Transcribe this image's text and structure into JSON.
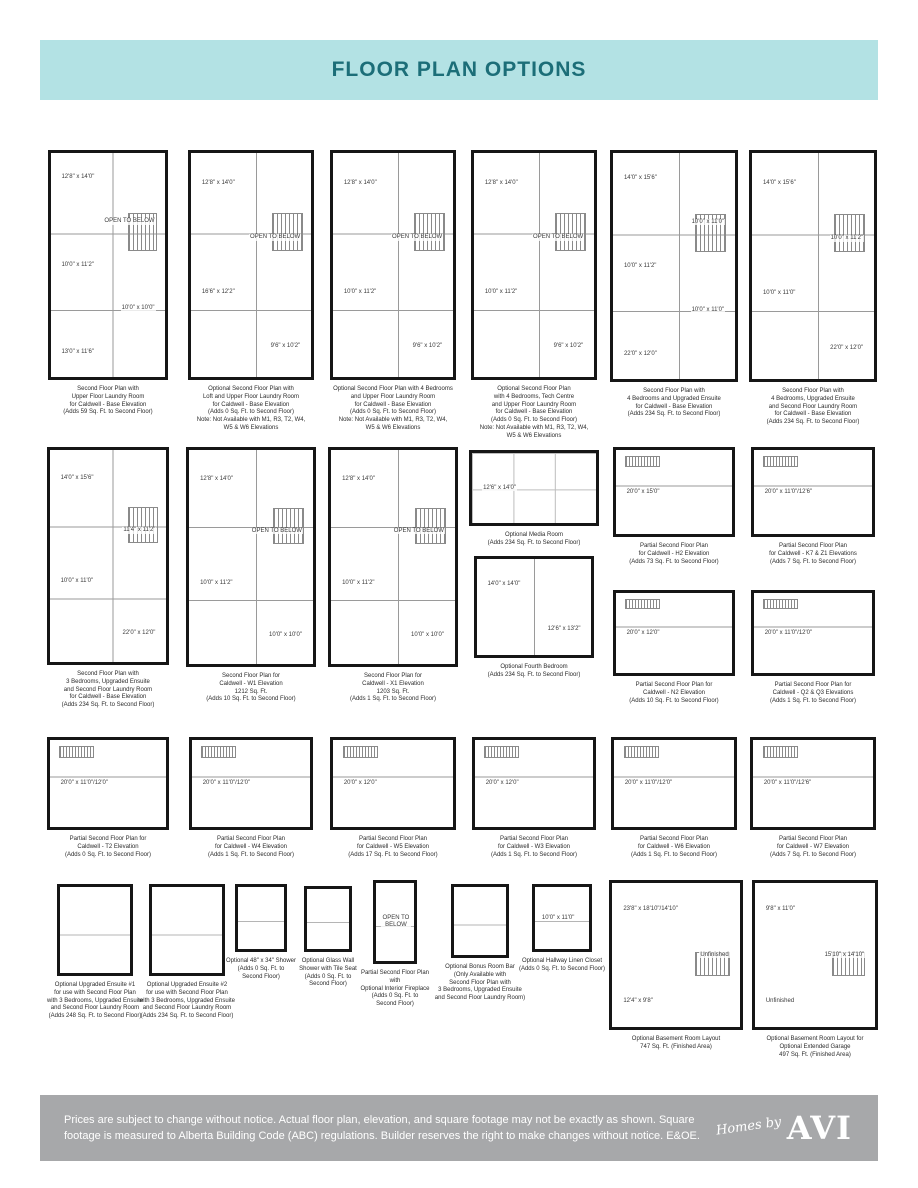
{
  "header": {
    "title": "FLOOR PLAN OPTIONS"
  },
  "colors": {
    "header_bg": "#b3e2e4",
    "header_text": "#1c6e78",
    "footer_bg": "#a7a8aa",
    "footer_text": "#ffffff",
    "plan_wall": "#161616"
  },
  "footer": {
    "disclaimer": "Prices are subject to change without notice. Actual floor plan, elevation, and square footage may not be exactly as shown. Square footage is measured to Alberta Building Code (ABC) regulations. Builder reserves the right to make changes without notice. E&OE.",
    "logo_script": "Homes by",
    "logo_main": "AVI"
  },
  "plans": [
    {
      "caption": "Second Floor Plan with\nUpper Floor Laundry Room\nfor Caldwell - Base Elevation\n(Adds 59 Sq. Ft. to Second Floor)",
      "labels": [
        "12'8\" x 14'0\"",
        "OPEN TO BELOW",
        "10'0\" x 11'2\"",
        "10'0\" x 10'0\"",
        "13'0\" x 11'6\""
      ]
    },
    {
      "caption": "Optional Second Floor Plan with\nLoft and Upper Floor Laundry Room\nfor Caldwell - Base Elevation\n(Adds 0 Sq. Ft. to Second Floor)\nNote: Not Available with M1, R3, T2, W4,\nW5 & W6 Elevations",
      "labels": [
        "12'8\" x 14'0\"",
        "OPEN TO BELOW",
        "16'6\" x 12'2\"",
        "9'6\" x 10'2\""
      ]
    },
    {
      "caption": "Optional Second Floor Plan with 4 Bedrooms\nand Upper Floor Laundry Room\nfor Caldwell - Base Elevation\n(Adds 0 Sq. Ft. to Second Floor)\nNote: Not Available with M1, R3, T2, W4,\nW5 & W6 Elevations",
      "labels": [
        "12'8\" x 14'0\"",
        "OPEN TO BELOW",
        "10'0\" x 11'2\"",
        "9'6\" x 10'2\""
      ]
    },
    {
      "caption": "Optional Second Floor Plan\nwith 4 Bedrooms, Tech Centre\nand Upper Floor Laundry Room\nfor Caldwell - Base Elevation\n(Adds 0 Sq. Ft. to Second Floor)\nNote: Not Available with M1, R3, T2, W4,\nW5 & W6 Elevations",
      "labels": [
        "12'8\" x 14'0\"",
        "OPEN TO BELOW",
        "10'0\" x 11'2\"",
        "9'6\" x 10'2\""
      ]
    },
    {
      "caption": "Second Floor Plan with\n4 Bedrooms and Upgraded Ensuite\nfor Caldwell - Base Elevation\n(Adds 234 Sq. Ft. to Second Floor)",
      "labels": [
        "14'0\" x 15'6\"",
        "10'0\" x 11'0\"",
        "10'0\" x 11'2\"",
        "10'0\" x 11'0\"",
        "22'0\" x 12'0\""
      ]
    },
    {
      "caption": "Second Floor Plan with\n4 Bedrooms, Upgraded Ensuite\nand Second Floor Laundry Room\nfor Caldwell - Base Elevation\n(Adds 234 Sq. Ft. to Second Floor)",
      "labels": [
        "14'0\" x 15'6\"",
        "10'0\" x 11'2\"",
        "10'0\" x 11'0\"",
        "22'0\" x 12'0\""
      ]
    },
    {
      "caption": "Second Floor Plan with\n3 Bedrooms, Upgraded Ensuite\nand Second Floor Laundry Room\nfor Caldwell - Base Elevation\n(Adds 234 Sq. Ft. to Second Floor)",
      "labels": [
        "14'0\" x 15'6\"",
        "11'4\" x 11'2\"",
        "10'0\" x 11'0\"",
        "22'0\" x 12'0\""
      ]
    },
    {
      "caption": "Second Floor Plan for\nCaldwell - W1 Elevation\n1212 Sq. Ft.\n(Adds 10 Sq. Ft. to Second Floor)",
      "labels": [
        "12'8\" x 14'0\"",
        "OPEN TO BELOW",
        "10'0\" x 11'2\"",
        "10'0\" x 10'0\""
      ]
    },
    {
      "caption": "Second Floor Plan for\nCaldwell - X1 Elevation\n1203 Sq. Ft.\n(Adds 1 Sq. Ft. to Second Floor)",
      "labels": [
        "12'8\" x 14'0\"",
        "OPEN TO BELOW",
        "10'0\" x 11'2\"",
        "10'0\" x 10'0\""
      ]
    },
    {
      "caption": "Optional Media Room\n(Adds 234 Sq. Ft. to Second Floor)",
      "labels": [
        "12'6\" x 14'0\""
      ]
    },
    {
      "caption": "Optional Fourth Bedroom\n(Adds 234 Sq. Ft. to Second Floor)",
      "labels": [
        "14'0\" x 14'0\"",
        "12'6\" x 13'2\""
      ]
    },
    {
      "caption": "Partial Second Floor Plan\nfor Caldwell - H2 Elevation\n(Adds 73 Sq. Ft. to Second Floor)",
      "labels": [
        "20'0\" x 15'0\""
      ]
    },
    {
      "caption": "Partial Second Floor Plan\nfor Caldwell - K7 & Z1 Elevations\n(Adds 7 Sq. Ft. to Second Floor)",
      "labels": [
        "20'0\" x 11'0\"/12'6\""
      ]
    },
    {
      "caption": "Partial Second Floor Plan for\nCaldwell - N2 Elevation\n(Adds 10 Sq. Ft. to Second Floor)",
      "labels": [
        "20'0\" x 12'0\""
      ]
    },
    {
      "caption": "Partial Second Floor Plan for\nCaldwell - Q2 & Q3 Elevations\n(Adds 1 Sq. Ft. to Second Floor)",
      "labels": [
        "20'0\" x 11'0\"/12'0\""
      ]
    },
    {
      "caption": "Partial Second Floor Plan for\nCaldwell - T2 Elevation\n(Adds 0 Sq. Ft. to Second Floor)",
      "labels": [
        "20'0\" x 11'0\"/12'0\""
      ]
    },
    {
      "caption": "Partial Second Floor Plan\nfor Caldwell - W4 Elevation\n(Adds 1 Sq. Ft. to Second Floor)",
      "labels": [
        "20'0\" x 11'0\"/12'0\""
      ]
    },
    {
      "caption": "Partial Second Floor Plan\nfor Caldwell - W5 Elevation\n(Adds 17 Sq. Ft. to Second Floor)",
      "labels": [
        "20'0\" x 12'0\""
      ]
    },
    {
      "caption": "Partial Second Floor Plan\nfor Caldwell - W3 Elevation\n(Adds 1 Sq. Ft. to Second Floor)",
      "labels": [
        "20'0\" x 12'0\""
      ]
    },
    {
      "caption": "Partial Second Floor Plan\nfor Caldwell - W6 Elevation\n(Adds 1 Sq. Ft. to Second Floor)",
      "labels": [
        "20'0\" x 11'0\"/12'0\""
      ]
    },
    {
      "caption": "Partial Second Floor Plan\nfor Caldwell - W7 Elevation\n(Adds 7 Sq. Ft. to Second Floor)",
      "labels": [
        "20'0\" x 11'0\"/12'6\""
      ]
    },
    {
      "caption": "Optional Upgraded Ensuite #1\nfor use with Second Floor Plan\nwith 3 Bedrooms, Upgraded Ensuite\nand Second Floor Laundry Room\n(Adds 248 Sq. Ft. to Second Floor)",
      "labels": []
    },
    {
      "caption": "Optional Upgraded Ensuite #2\nfor use with Second Floor Plan\nwith 3 Bedrooms, Upgraded Ensuite\nand Second Floor Laundry Room\n(Adds 234 Sq. Ft. to Second Floor)",
      "labels": []
    },
    {
      "caption": "Optional 48\" x 34\" Shower\n(Adds 0 Sq. Ft. to\nSecond Floor)",
      "labels": []
    },
    {
      "caption": "Optional Glass Wall\nShower with Tile Seat\n(Adds 0 Sq. Ft. to\nSecond Floor)",
      "labels": []
    },
    {
      "caption": "Partial Second Floor Plan with\nOptional Interior Fireplace\n(Adds 0 Sq. Ft. to\nSecond Floor)",
      "labels": [
        "OPEN TO BELOW"
      ]
    },
    {
      "caption": "Optional Bonus Room Bar\n(Only Available with\nSecond Floor Plan with\n3 Bedrooms, Upgraded Ensuite\nand Second Floor Laundry Room)",
      "labels": []
    },
    {
      "caption": "Optional Hallway Linen Closet\n(Adds 0 Sq. Ft. to Second Floor)",
      "labels": [
        "10'0\" x 11'0\""
      ]
    },
    {
      "caption": "Optional Basement Room Layout\n747 Sq. Ft. (Finished Area)",
      "labels": [
        "23'8\" x 18'10\"/14'10\"",
        "Unfinished",
        "12'4\" x 9'8\""
      ]
    },
    {
      "caption": "Optional Basement Room Layout for\nOptional Extended Garage\n497 Sq. Ft. (Finished Area)",
      "labels": [
        "9'8\" x 11'0\"",
        "15'10\" x 14'10\"",
        "Unfinished"
      ]
    }
  ]
}
